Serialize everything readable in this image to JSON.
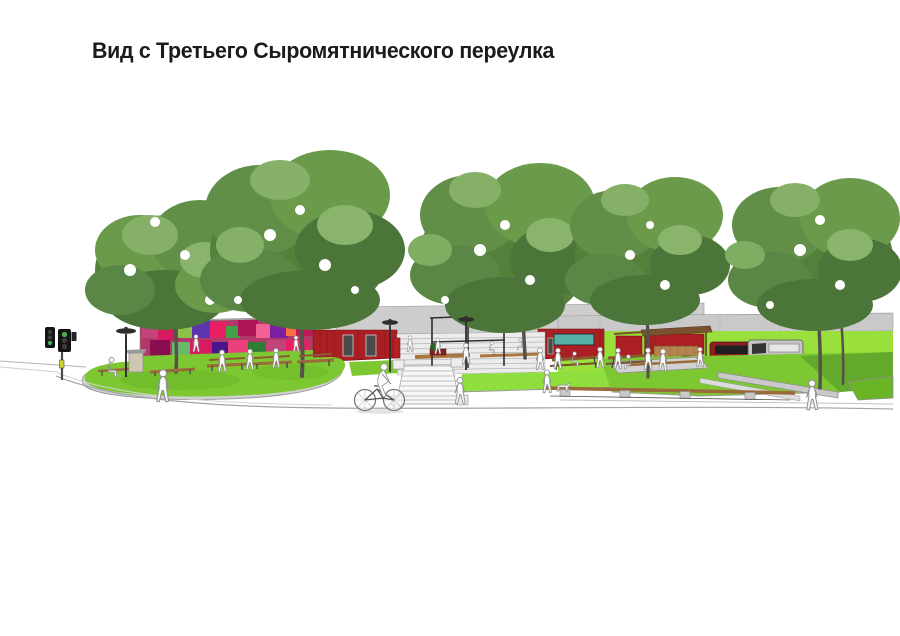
{
  "slide": {
    "title": "Вид с Третьего Сыромятнического переулка",
    "background": "#ffffff",
    "title_color": "#1b1b1b"
  },
  "scene": {
    "type": "architectural-rendering",
    "objects": [
      "street trees",
      "graffiti mural wall",
      "red pavilions",
      "bright green fence",
      "gray wall band",
      "amphitheater steps",
      "pergola",
      "front staircase",
      "lawns with concrete curbs",
      "wooden benches",
      "picnic tables",
      "food kiosk",
      "street lamps",
      "traffic light",
      "parked vans",
      "pedestrians",
      "cyclist",
      "dog",
      "curved road curb",
      "info stand",
      "trash bin"
    ],
    "colors": {
      "foliage": "#55803c",
      "lawn": "#7dc832",
      "fence_green": "#9ae03c",
      "wall_gray": "#c9c9c9",
      "pavilion_red": "#ab1f24",
      "mural_pink": "#d81b60",
      "wood": "#9b6a3a",
      "window_teal": "#57b0a4"
    }
  }
}
